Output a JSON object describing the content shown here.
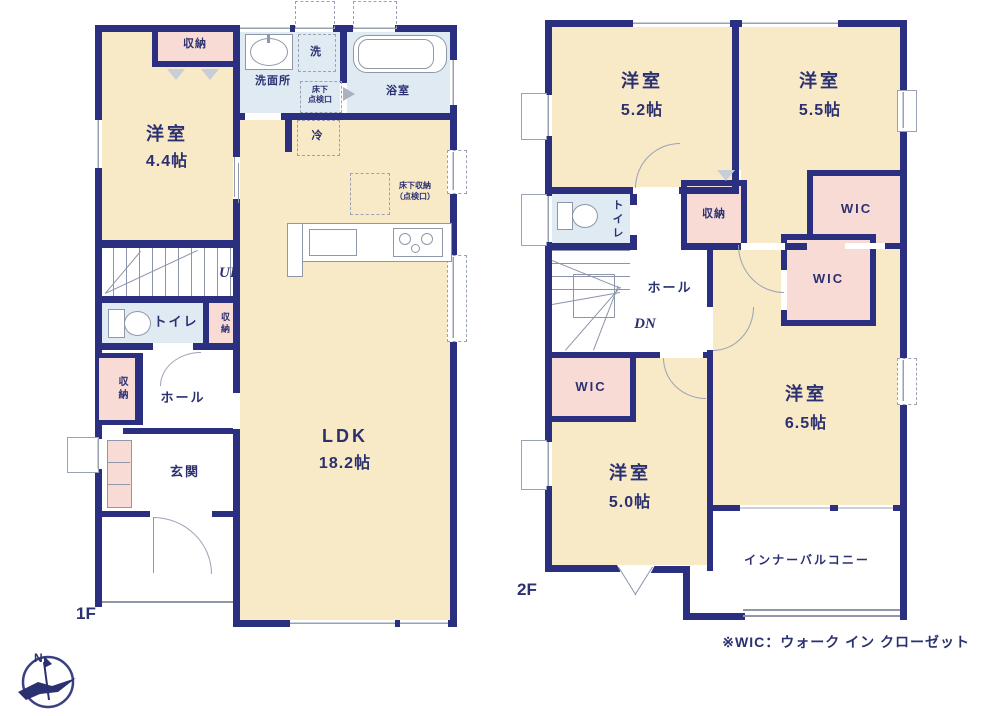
{
  "annotations": {
    "floor1_label": "1F",
    "floor2_label": "2F",
    "note": "※WIC：ウォーク イン クローゼット",
    "up": "UP",
    "down": "DN",
    "north": "N"
  },
  "colors": {
    "wall": "#2a2f80",
    "room_cream": "#f8e9c7",
    "closet_pink": "#f9dbd6",
    "wet_blue": "#e0eaf3",
    "text_navy": "#2b3070"
  },
  "floor1": {
    "western_room_name": "洋室",
    "western_room_area": "4.4帖",
    "closet_bedroom": "収納",
    "washroom": "洗面所",
    "washer": "洗",
    "bathroom": "浴室",
    "underfloor_hatch_line1": "床下",
    "underfloor_hatch_line2": "点検口",
    "fridge": "冷",
    "underfloor_storage_line1": "床下収納",
    "underfloor_storage_line2": "（点検口）",
    "ldk_name": "LDK",
    "ldk_area": "18.2帖",
    "toilet": "トイレ",
    "closet_toilet": "収納",
    "closet_hall": "収納",
    "hall": "ホール",
    "entrance": "玄関"
  },
  "floor2": {
    "room52_name": "洋室",
    "room52_area": "5.2帖",
    "room55_name": "洋室",
    "room55_area": "5.5帖",
    "room65_name": "洋室",
    "room65_area": "6.5帖",
    "room50_name": "洋室",
    "room50_area": "5.0帖",
    "toilet": "トイレ",
    "closet": "収納",
    "hall": "ホール",
    "wic_a": "WIC",
    "wic_b": "WIC",
    "wic_c": "WIC",
    "balcony": "インナーバルコニー"
  }
}
